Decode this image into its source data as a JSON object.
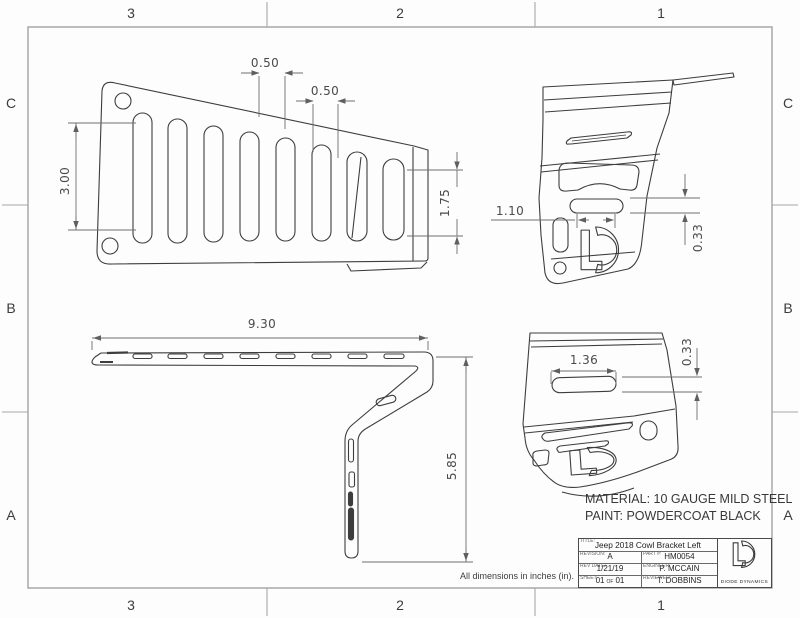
{
  "sheet": {
    "type": "engineering-drawing",
    "units_note": "All dimensions in inches (in).",
    "material_note": "MATERIAL: 10 GAUGE MILD STEEL",
    "paint_note": "PAINT: POWDERCOAT BLACK"
  },
  "zones": {
    "top": [
      "3",
      "2",
      "1"
    ],
    "bottom": [
      "3",
      "2",
      "1"
    ],
    "left": [
      "C",
      "B",
      "A"
    ],
    "right": [
      "C",
      "B",
      "A"
    ]
  },
  "dimensions": {
    "front_slot_spacing_1": "0.50",
    "front_slot_spacing_2": "0.50",
    "front_slot_length": "3.00",
    "front_right_slot_length": "1.75",
    "side_overall_width": "9.30",
    "side_overall_height": "5.85",
    "iso_top_slot_width": "1.10",
    "iso_top_slot_height": "0.33",
    "iso_bottom_slot_width": "1.36",
    "iso_bottom_slot_height": "0.33"
  },
  "title_block": {
    "title_label": "TITLE:",
    "title": "Jeep 2018 Cowl Bracket Left",
    "revision_label": "REVISION:",
    "revision": "A",
    "part_label": "PART #:",
    "part_number": "HM0054",
    "rev_date_label": "REV DATE:",
    "rev_date": "1/21/19",
    "engineer_label": "ENGINEER:",
    "engineer": "P. MCCAIN",
    "sheet_label": "SHEET:",
    "sheet_current": "01",
    "sheet_of": "OF",
    "sheet_total": "01",
    "reviewed_label": "REVIEWED:",
    "reviewed": "T. DOBBINS",
    "company": "DIODE DYNAMICS"
  },
  "colors": {
    "part_line": "#3d3d3d",
    "dimension_line": "#6e6e6e",
    "frame_line": "#a8a8a8",
    "background": "#fdfdfd"
  }
}
